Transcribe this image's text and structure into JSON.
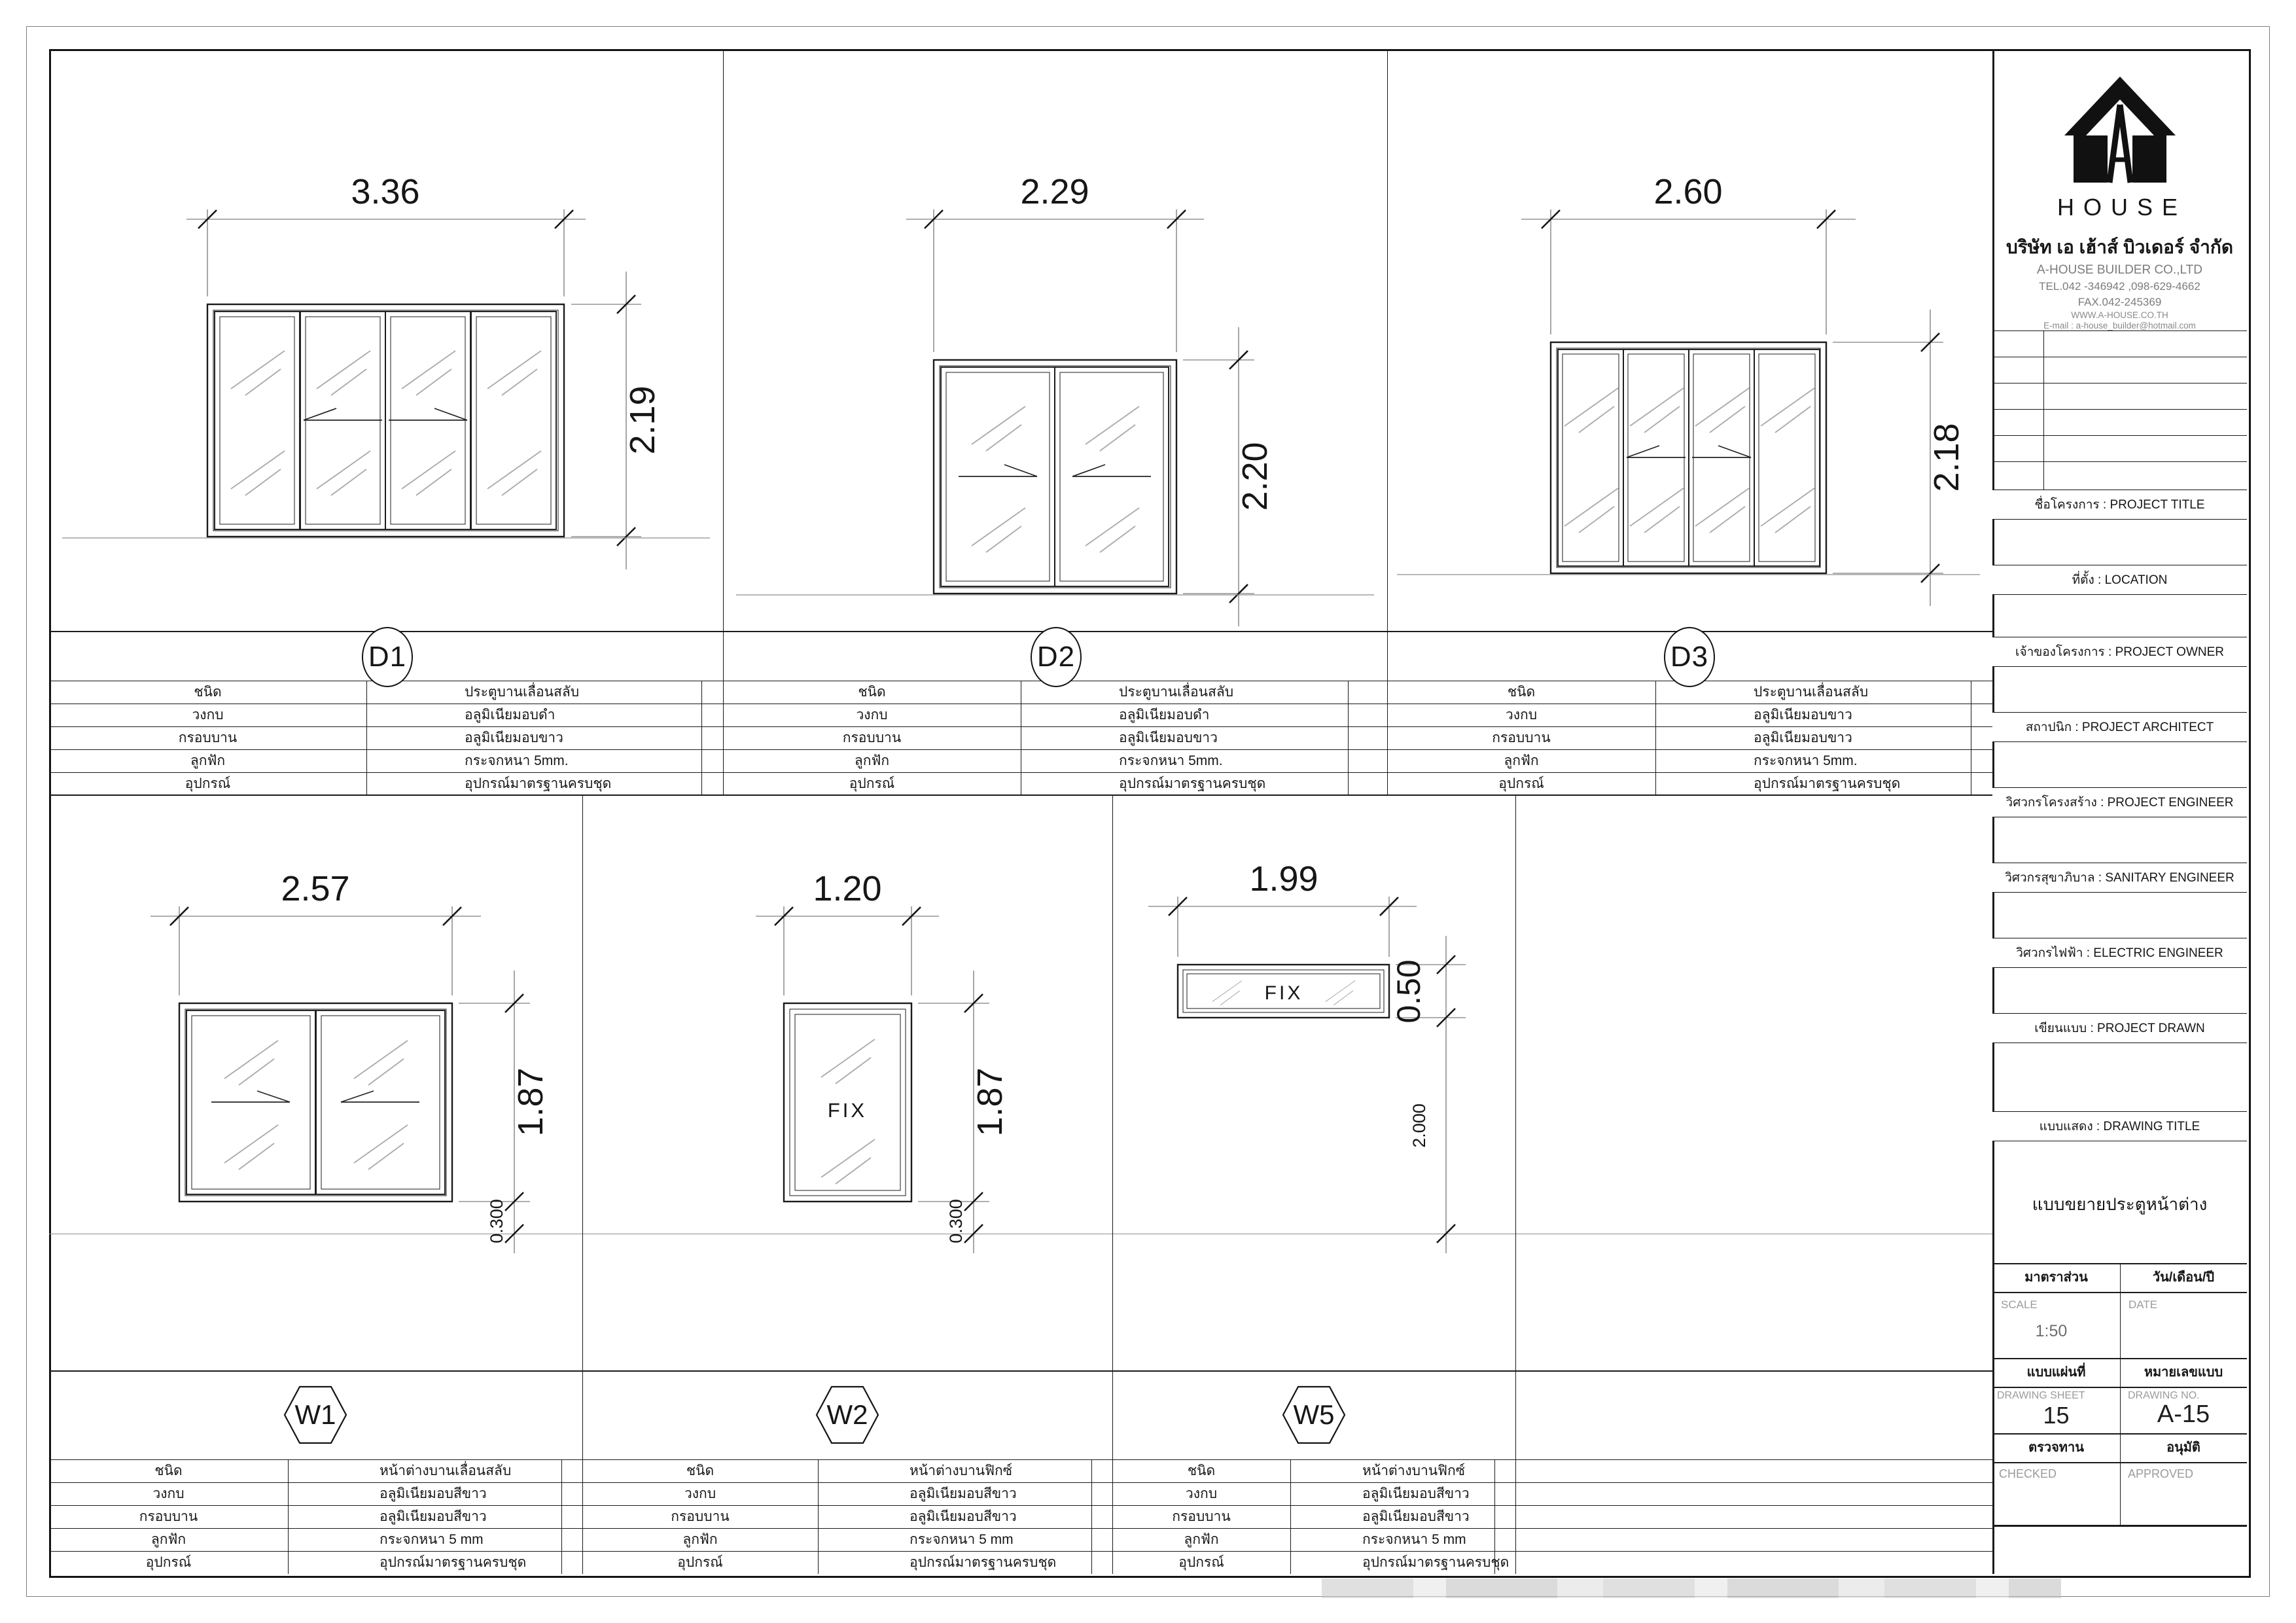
{
  "company": {
    "logo_word": "HOUSE",
    "name_th": "บริษัท เอ เฮ้าส์ บิวเดอร์ จำกัด",
    "name_en": "A-HOUSE BUILDER CO.,LTD",
    "tel": "TEL.042 -346942 ,098-629-4662",
    "fax": "FAX.042-245369",
    "website": "WWW.A-HOUSE.CO.TH",
    "email": "E-mail : a-house_builder@hotmail.com"
  },
  "titleblock": {
    "fields": [
      "ชื่อโครงการ : PROJECT TITLE",
      "ที่ตั้ง : LOCATION",
      "เจ้าของโครงการ : PROJECT OWNER",
      "สถาปนิก : PROJECT ARCHITECT",
      "วิศวกรโครงสร้าง : PROJECT ENGINEER",
      "วิศวกรสุขาภิบาล : SANITARY ENGINEER",
      "วิศวกรไฟฟ้า : ELECTRIC ENGINEER",
      "เขียนแบบ : PROJECT DRAWN",
      "แบบแสดง : DRAWING TITLE"
    ],
    "drawing_title": "แบบขยายประตูหน้าต่าง",
    "scale_header": "มาตราส่วน",
    "scale_label": "SCALE",
    "scale_value": "1:50",
    "date_header": "วัน/เดือน/ปี",
    "date_label": "DATE",
    "sheet_header": "แบบแผ่นที่",
    "sheet_label": "DRAWING SHEET",
    "sheet_value": "15",
    "no_header": "หมายเลขแบบ",
    "no_label": "DRAWING NO.",
    "no_value": "A-15",
    "checked_header": "ตรวจทาน",
    "checked_label": "CHECKED",
    "approved_header": "อนุมัติ",
    "approved_label": "APPROVED"
  },
  "spec_labels": [
    "ชนิด",
    "วงกบ",
    "กรอบบาน",
    "ลูกฟัก",
    "อุปกรณ์"
  ],
  "units": {
    "D1": {
      "label": "D1",
      "width": "3.36",
      "height": "2.19",
      "specs": [
        "ประตูบานเลื่อนสลับ",
        "อลูมิเนียมอบดำ",
        "อลูมิเนียมอบขาว",
        "กระจกหนา 5mm.",
        "อุปกรณ์มาตรฐานครบชุด"
      ]
    },
    "D2": {
      "label": "D2",
      "width": "2.29",
      "height": "2.20",
      "specs": [
        "ประตูบานเลื่อนสลับ",
        "อลูมิเนียมอบดำ",
        "อลูมิเนียมอบขาว",
        "กระจกหนา 5mm.",
        "อุปกรณ์มาตรฐานครบชุด"
      ]
    },
    "D3": {
      "label": "D3",
      "width": "2.60",
      "height": "2.18",
      "specs": [
        "ประตูบานเลื่อนสลับ",
        "อลูมิเนียมอบขาว",
        "อลูมิเนียมอบขาว",
        "กระจกหนา 5mm.",
        "อุปกรณ์มาตรฐานครบชุด"
      ]
    },
    "W1": {
      "label": "W1",
      "width": "2.57",
      "height": "1.87",
      "sill": "0.300",
      "specs": [
        "หน้าต่างบานเลื่อนสลับ",
        "อลูมิเนียมอบสีขาว",
        "อลูมิเนียมอบสีขาว",
        "กระจกหนา 5 mm",
        "อุปกรณ์มาตรฐานครบชุด"
      ]
    },
    "W2": {
      "label": "W2",
      "width": "1.20",
      "height": "1.87",
      "sill": "0.300",
      "fix_label": "FIX",
      "specs": [
        "หน้าต่างบานฟิกซ์",
        "อลูมิเนียมอบสีขาว",
        "อลูมิเนียมอบสีขาว",
        "กระจกหนา 5 mm",
        "อุปกรณ์มาตรฐานครบชุด"
      ]
    },
    "W5": {
      "label": "W5",
      "width": "1.99",
      "height": "0.50",
      "sill": "2.000",
      "fix_label": "FIX",
      "specs": [
        "หน้าต่างบานฟิกซ์",
        "อลูมิเนียมอบสีขาว",
        "อลูมิเนียมอบสีขาว",
        "กระจกหนา 5 mm",
        "อุปกรณ์มาตรฐานครบชุด"
      ]
    }
  }
}
